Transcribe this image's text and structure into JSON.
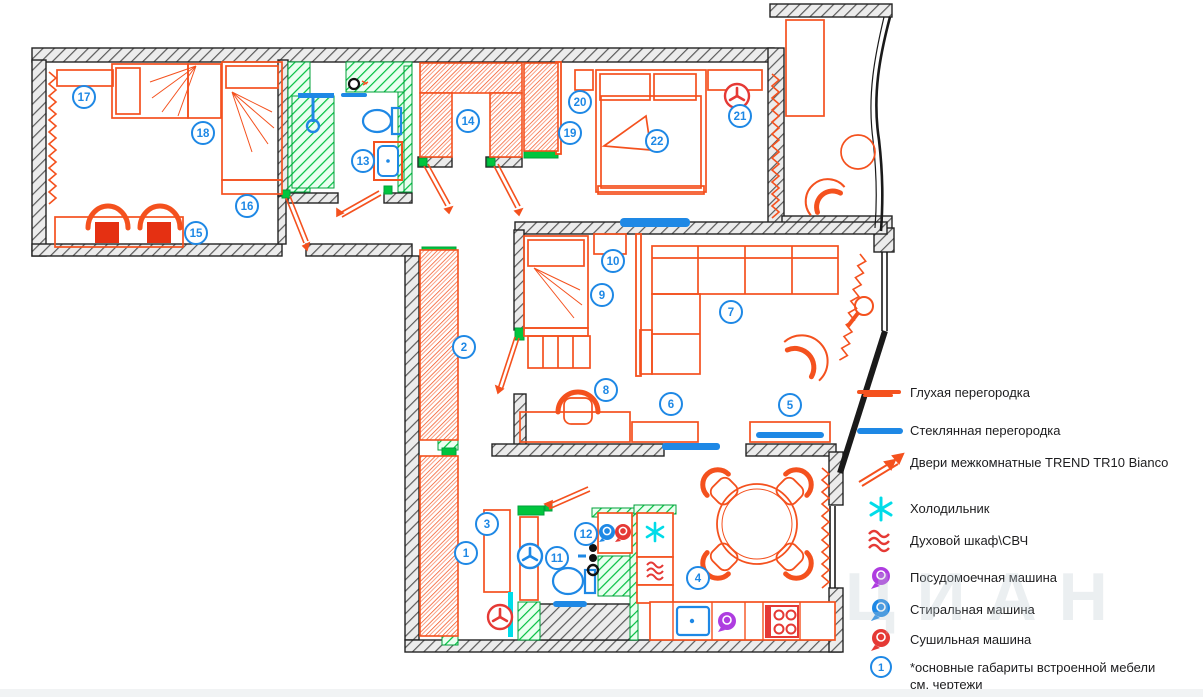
{
  "watermark": "ЦИАН",
  "colors": {
    "partition_red": "#f4511e",
    "glass_blue": "#1e88e5",
    "marker_blue": "#1e88e5",
    "tile_green": "#00c53e",
    "fridge_cyan": "#00dce8",
    "dishwasher_purple": "#ae3ce0",
    "dryer_red": "#e53935",
    "wall_dark": "#3c3c3c"
  },
  "legend": {
    "items": [
      {
        "symbol": "solid-partition-icon",
        "label": "Глухая перегородка"
      },
      {
        "symbol": "glass-partition-icon",
        "label": "Стеклянная перегородка"
      },
      {
        "symbol": "door-icon",
        "label": "Двери межкомнатные TREND TR10 Bianco"
      },
      {
        "symbol": "fridge-icon",
        "label": "Холодильник"
      },
      {
        "symbol": "oven-icon",
        "label": "Духовой шкаф\\СВЧ"
      },
      {
        "symbol": "dishwasher-icon",
        "label": "Посудомоечная машина"
      },
      {
        "symbol": "washer-icon",
        "label": "Стиральная машина"
      },
      {
        "symbol": "dryer-icon",
        "label": "Сушильная машина"
      },
      {
        "symbol": "note-icon",
        "label": "*основные габариты встроенной мебели см. чертежи"
      }
    ],
    "note_number": "1"
  },
  "markers": [
    {
      "n": "1",
      "x": 466,
      "y": 553
    },
    {
      "n": "2",
      "x": 464,
      "y": 347
    },
    {
      "n": "3",
      "x": 487,
      "y": 524
    },
    {
      "n": "4",
      "x": 698,
      "y": 578
    },
    {
      "n": "5",
      "x": 790,
      "y": 405
    },
    {
      "n": "6",
      "x": 671,
      "y": 404
    },
    {
      "n": "7",
      "x": 731,
      "y": 312
    },
    {
      "n": "8",
      "x": 606,
      "y": 390
    },
    {
      "n": "9",
      "x": 602,
      "y": 295
    },
    {
      "n": "10",
      "x": 613,
      "y": 261
    },
    {
      "n": "11",
      "x": 557,
      "y": 558
    },
    {
      "n": "12",
      "x": 586,
      "y": 534
    },
    {
      "n": "13",
      "x": 363,
      "y": 161
    },
    {
      "n": "14",
      "x": 468,
      "y": 121
    },
    {
      "n": "15",
      "x": 196,
      "y": 233
    },
    {
      "n": "16",
      "x": 247,
      "y": 206
    },
    {
      "n": "17",
      "x": 84,
      "y": 97
    },
    {
      "n": "18",
      "x": 203,
      "y": 133
    },
    {
      "n": "19",
      "x": 570,
      "y": 133
    },
    {
      "n": "20",
      "x": 580,
      "y": 102
    },
    {
      "n": "21",
      "x": 740,
      "y": 116
    },
    {
      "n": "22",
      "x": 657,
      "y": 141
    }
  ],
  "symbols": [
    {
      "type": "vent-red",
      "x": 737,
      "y": 96
    },
    {
      "type": "vent-red",
      "x": 500,
      "y": 617
    },
    {
      "type": "fan-blue",
      "x": 530,
      "y": 556
    },
    {
      "type": "lamp-red",
      "x": 864,
      "y": 306
    }
  ]
}
